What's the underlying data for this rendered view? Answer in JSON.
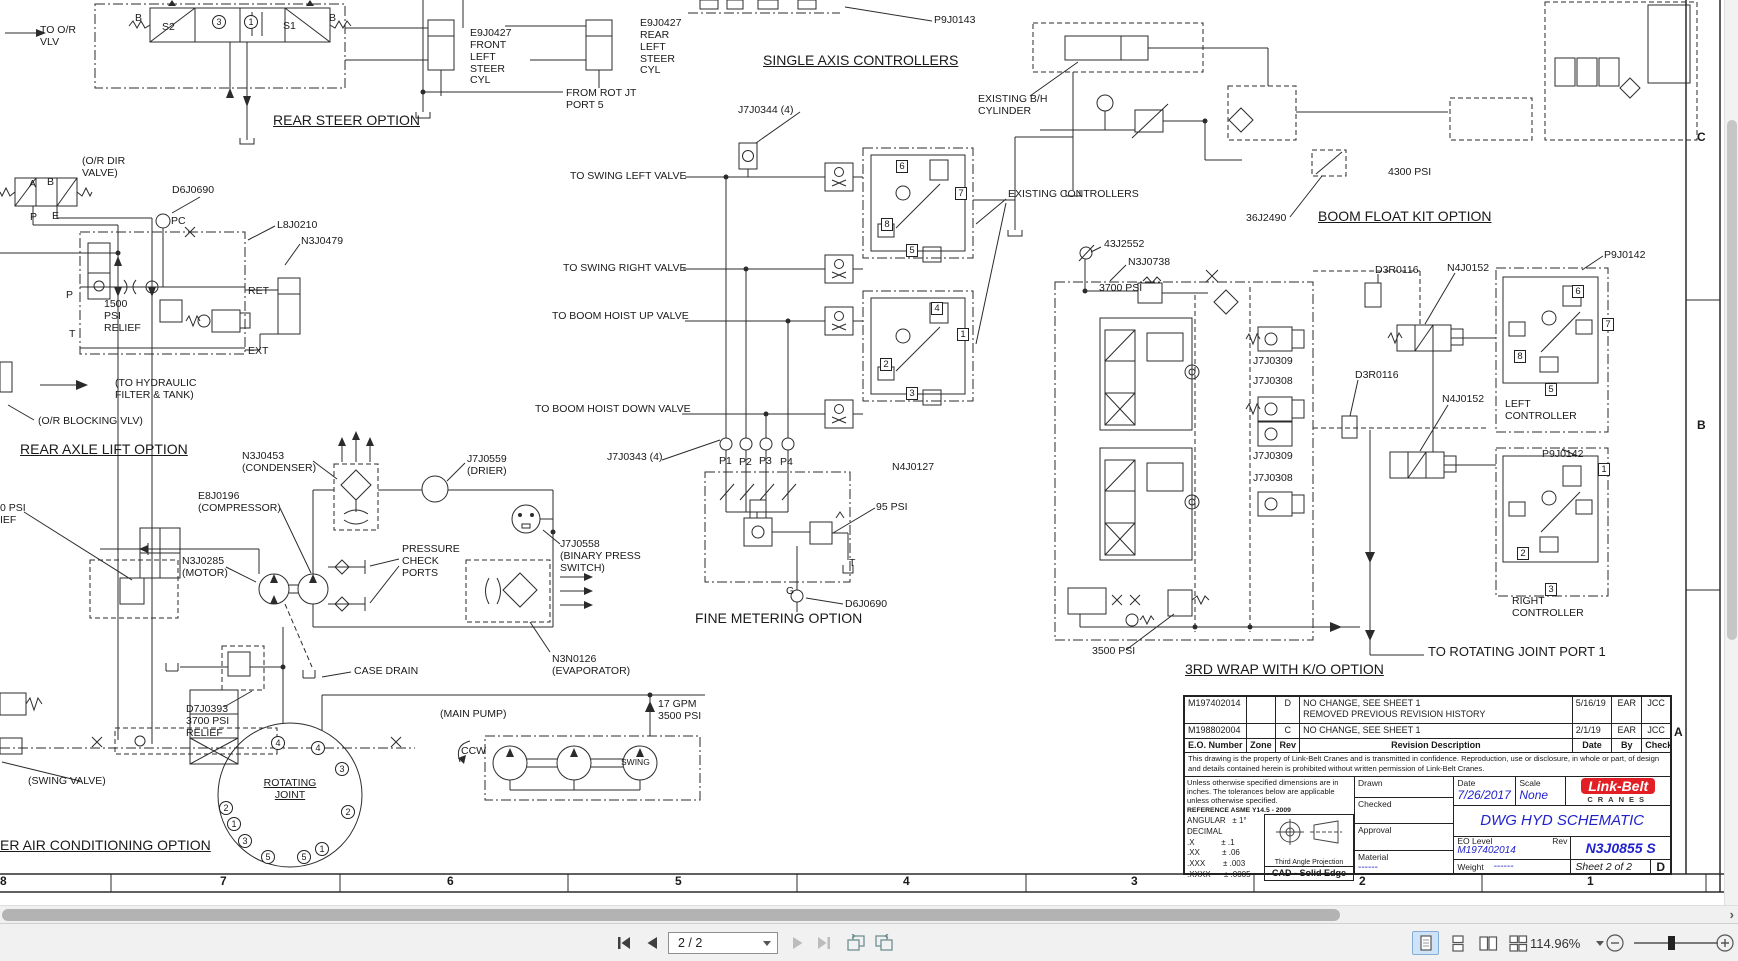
{
  "viewer": {
    "toolbar": {
      "page_indicator": "2 / 2",
      "zoom_value": "114.96%",
      "icons": {
        "first_page": "bar-left-triangle",
        "previous_page": "left-triangle",
        "next_page": "right-triangle",
        "last_page": "right-triangle-bar",
        "rotate_left": "page-rotate-left",
        "rotate_right": "page-rotate-right",
        "layout_modes": [
          "single-page",
          "one-column",
          "two-page",
          "two-column"
        ],
        "zoom_out": "minus-circle",
        "zoom_in": "plus-circle"
      }
    },
    "hscroll_arrow": "›"
  },
  "drawing": {
    "title_block": {
      "revision_table": {
        "headers": {
          "eo": "E.O. Number",
          "zone": "Zone",
          "rev": "Rev",
          "desc": "Revision Description",
          "date": "Date",
          "by": "By",
          "check": "Check"
        },
        "rows": [
          {
            "eo": "M197402014",
            "zone": "",
            "rev": "D",
            "desc": "NO CHANGE, SEE SHEET 1\nREMOVED PREVIOUS REVISION HISTORY",
            "date": "5/16/19",
            "by": "EAR",
            "check": "JCC"
          },
          {
            "eo": "M198802004",
            "zone": "",
            "rev": "C",
            "desc": "NO CHANGE, SEE SHEET 1",
            "date": "2/1/19",
            "by": "EAR",
            "check": "JCC"
          }
        ]
      },
      "property_note": "This drawing is the property of Link-Belt Cranes and is transmitted in confidence. Reproduction, use or disclosure, in whole or part, of design and details contained herein is prohibited without written permission of Link-Belt Cranes.",
      "tolerance_note": "Unless otherwise specified dimensions are in\ninches.  The tolerances below are applicable\nunless otherwise specified.",
      "reference": "REFERENCE ASME Y14.5 - 2009",
      "tolerances": [
        "ANGULAR   ± 1°",
        "DECIMAL",
        ".X            ± .1",
        ".XX          ± .06",
        ".XXX        ± .003",
        ".XXXX      ± .0005"
      ],
      "projection_label": "Third Angle Projection",
      "cad_label": "CAD - Solid Edge",
      "drawn_label": "Drawn",
      "checked_label": "Checked",
      "approval_label": "Approval",
      "material_label": "Material",
      "material_value": "------",
      "date_label": "Date",
      "date_value": "7/26/2017",
      "scale_label": "Scale",
      "scale_value": "None",
      "eo_level_label": "EO Level",
      "rev_label": "Rev",
      "eo_level_value": "M197402014",
      "weight_label": "Weight",
      "weight_value": "------",
      "drawing_title": "DWG HYD SCHEMATIC",
      "drawing_number": "N3J0855 S",
      "sheet_label": "Sheet 2 of 2",
      "size_letter": "D",
      "logo_brand": "Link-Belt",
      "logo_sub": "CRANES"
    },
    "labels": [
      {
        "t": "TO O/R\nVLV",
        "x": 40,
        "y": 25
      },
      {
        "t": "B",
        "x": 135,
        "y": 13
      },
      {
        "t": "S2",
        "x": 162,
        "y": 22
      },
      {
        "t": "3",
        "x": 212,
        "y": 15,
        "circ": 1
      },
      {
        "t": "1",
        "x": 244,
        "y": 15,
        "circ": 1
      },
      {
        "t": "S1",
        "x": 283,
        "y": 21
      },
      {
        "t": "B",
        "x": 329,
        "y": 13
      },
      {
        "t": "REAR STEER OPTION",
        "x": 273,
        "y": 113,
        "s": 14,
        "u": 1,
        "n": "title-rear-steer-option"
      },
      {
        "t": "E9J0427\nFRONT\nLEFT\nSTEER\nCYL",
        "x": 470,
        "y": 28
      },
      {
        "t": "E9J0427\nREAR\nLEFT\nSTEER\nCYL",
        "x": 640,
        "y": 18
      },
      {
        "t": "FROM ROT JT\nPORT 5",
        "x": 566,
        "y": 88
      },
      {
        "t": "SINGLE AXIS CONTROLLERS",
        "x": 763,
        "y": 53,
        "s": 14,
        "u": 1,
        "n": "title-single-axis-controllers"
      },
      {
        "t": "P9J0143",
        "x": 934,
        "y": 15
      },
      {
        "t": "J7J0344 (4)",
        "x": 738,
        "y": 105
      },
      {
        "t": "EXISTING B/H\nCYLINDER",
        "x": 978,
        "y": 94
      },
      {
        "t": "EXISTING CONTROLLERS",
        "x": 1008,
        "y": 189
      },
      {
        "t": "4300 PSI",
        "x": 1388,
        "y": 167
      },
      {
        "t": "36J2490",
        "x": 1246,
        "y": 213
      },
      {
        "t": "BOOM FLOAT KIT OPTION",
        "x": 1318,
        "y": 209,
        "s": 14,
        "u": 1,
        "n": "title-boom-float-kit-option"
      },
      {
        "t": "(O/R DIR\nVALVE)",
        "x": 82,
        "y": 156
      },
      {
        "t": "A",
        "x": 29,
        "y": 179
      },
      {
        "t": "B",
        "x": 47,
        "y": 177
      },
      {
        "t": "P",
        "x": 30,
        "y": 212
      },
      {
        "t": "E",
        "x": 52,
        "y": 211
      },
      {
        "t": "D6J0690",
        "x": 172,
        "y": 185
      },
      {
        "t": "PC",
        "x": 171,
        "y": 216
      },
      {
        "t": "L8J0210",
        "x": 277,
        "y": 220
      },
      {
        "t": "N3J0479",
        "x": 301,
        "y": 236
      },
      {
        "t": "1500\nPSI\nRELIEF",
        "x": 104,
        "y": 299
      },
      {
        "t": "P",
        "x": 66,
        "y": 290
      },
      {
        "t": "T",
        "x": 69,
        "y": 329
      },
      {
        "t": "RET",
        "x": 248,
        "y": 286
      },
      {
        "t": "EXT",
        "x": 248,
        "y": 346
      },
      {
        "t": "(TO HYDRAULIC\nFILTER & TANK)",
        "x": 115,
        "y": 378
      },
      {
        "t": "(O/R BLOCKING VLV)",
        "x": 38,
        "y": 416
      },
      {
        "t": "REAR AXLE LIFT OPTION",
        "x": 20,
        "y": 442,
        "s": 14,
        "u": 1,
        "n": "title-rear-axle-lift-option"
      },
      {
        "t": "0 PSI",
        "x": 0,
        "y": 503
      },
      {
        "t": "IEF",
        "x": 0,
        "y": 515
      },
      {
        "t": "TO SWING LEFT VALVE",
        "x": 570,
        "y": 171
      },
      {
        "t": "TO SWING RIGHT VALVE",
        "x": 563,
        "y": 263
      },
      {
        "t": "TO BOOM HOIST UP VALVE",
        "x": 552,
        "y": 311
      },
      {
        "t": "TO BOOM HOIST DOWN VALVE",
        "x": 535,
        "y": 404
      },
      {
        "t": "6",
        "x": 896,
        "y": 160,
        "box": 1
      },
      {
        "t": "7",
        "x": 955,
        "y": 187,
        "box": 1
      },
      {
        "t": "8",
        "x": 881,
        "y": 218,
        "box": 1
      },
      {
        "t": "5",
        "x": 906,
        "y": 244,
        "box": 1
      },
      {
        "t": "4",
        "x": 931,
        "y": 302,
        "box": 1
      },
      {
        "t": "1",
        "x": 957,
        "y": 328,
        "box": 1
      },
      {
        "t": "2",
        "x": 880,
        "y": 358,
        "box": 1
      },
      {
        "t": "3",
        "x": 906,
        "y": 387,
        "box": 1
      },
      {
        "t": "J7J0343 (4)",
        "x": 607,
        "y": 452
      },
      {
        "t": "P1",
        "x": 719,
        "y": 456
      },
      {
        "t": "P2",
        "x": 739,
        "y": 457
      },
      {
        "t": "P3",
        "x": 759,
        "y": 456
      },
      {
        "t": "P4",
        "x": 780,
        "y": 457
      },
      {
        "t": "N4J0127",
        "x": 892,
        "y": 462
      },
      {
        "t": "95 PSI",
        "x": 876,
        "y": 502
      },
      {
        "t": "T",
        "x": 849,
        "y": 558
      },
      {
        "t": "G",
        "x": 786,
        "y": 586
      },
      {
        "t": "D6J0690",
        "x": 845,
        "y": 599
      },
      {
        "t": "FINE METERING OPTION",
        "x": 695,
        "y": 611,
        "s": 14,
        "n": "title-fine-metering-option"
      },
      {
        "t": "N3J0453\n(CONDENSER)",
        "x": 242,
        "y": 451
      },
      {
        "t": "J7J0559\n(DRIER)",
        "x": 467,
        "y": 454
      },
      {
        "t": "E8J0196\n(COMPRESSOR)",
        "x": 198,
        "y": 491
      },
      {
        "t": "N3J0285\n(MOTOR)",
        "x": 182,
        "y": 556
      },
      {
        "t": "PRESSURE\nCHECK\nPORTS",
        "x": 402,
        "y": 544
      },
      {
        "t": "J7J0558\n(BINARY PRESS\nSWITCH)",
        "x": 560,
        "y": 539
      },
      {
        "t": "CASE DRAIN",
        "x": 354,
        "y": 666
      },
      {
        "t": "N3N0126\n(EVAPORATOR)",
        "x": 552,
        "y": 654
      },
      {
        "t": "D7J0393\n3700 PSI\nRELIEF",
        "x": 186,
        "y": 704
      },
      {
        "t": "ROTATING\nJOINT",
        "x": 258,
        "y": 778,
        "u": 1,
        "ctr": 1,
        "w": 64,
        "n": "label-rotating-joint"
      },
      {
        "t": "4",
        "x": 271,
        "y": 736,
        "circ": 1
      },
      {
        "t": "4",
        "x": 311,
        "y": 741,
        "circ": 1
      },
      {
        "t": "3",
        "x": 335,
        "y": 762,
        "circ": 1
      },
      {
        "t": "2",
        "x": 341,
        "y": 805,
        "circ": 1
      },
      {
        "t": "1",
        "x": 315,
        "y": 842,
        "circ": 1
      },
      {
        "t": "5",
        "x": 297,
        "y": 850,
        "circ": 1
      },
      {
        "t": "5",
        "x": 261,
        "y": 850,
        "circ": 1
      },
      {
        "t": "3",
        "x": 238,
        "y": 834,
        "circ": 1
      },
      {
        "t": "1",
        "x": 227,
        "y": 817,
        "circ": 1
      },
      {
        "t": "2",
        "x": 219,
        "y": 801,
        "circ": 1
      },
      {
        "t": "(SWING VALVE)",
        "x": 28,
        "y": 776
      },
      {
        "t": "ER AIR CONDITIONING OPTION",
        "x": 0,
        "y": 838,
        "s": 14,
        "u": 1,
        "n": "title-air-conditioning-option"
      },
      {
        "t": "(MAIN PUMP)",
        "x": 440,
        "y": 709
      },
      {
        "t": "CCW",
        "x": 461,
        "y": 746
      },
      {
        "t": "SWING",
        "x": 621,
        "y": 758,
        "s": 8.5
      },
      {
        "t": "17 GPM\n3500 PSI",
        "x": 658,
        "y": 699
      },
      {
        "t": "43J2552",
        "x": 1104,
        "y": 239
      },
      {
        "t": "N3J0738",
        "x": 1128,
        "y": 257
      },
      {
        "t": "3700 PSI",
        "x": 1099,
        "y": 283
      },
      {
        "t": "D3R0116",
        "x": 1375,
        "y": 265
      },
      {
        "t": "N4J0152",
        "x": 1447,
        "y": 263
      },
      {
        "t": "J7J0309",
        "x": 1253,
        "y": 356
      },
      {
        "t": "J7J0308",
        "x": 1253,
        "y": 376
      },
      {
        "t": "D3R0116",
        "x": 1355,
        "y": 370
      },
      {
        "t": "N4J0152",
        "x": 1442,
        "y": 394
      },
      {
        "t": "J7J0309",
        "x": 1253,
        "y": 451
      },
      {
        "t": "J7J0308",
        "x": 1253,
        "y": 473
      },
      {
        "t": "P9J0142",
        "x": 1604,
        "y": 250
      },
      {
        "t": "P9J0142",
        "x": 1542,
        "y": 449
      },
      {
        "t": "6",
        "x": 1572,
        "y": 285,
        "box": 1
      },
      {
        "t": "7",
        "x": 1602,
        "y": 318,
        "box": 1
      },
      {
        "t": "8",
        "x": 1514,
        "y": 350,
        "box": 1
      },
      {
        "t": "5",
        "x": 1545,
        "y": 383,
        "box": 1
      },
      {
        "t": "LEFT\nCONTROLLER",
        "x": 1505,
        "y": 399
      },
      {
        "t": "1",
        "x": 1598,
        "y": 463,
        "box": 1
      },
      {
        "t": "2",
        "x": 1517,
        "y": 547,
        "box": 1
      },
      {
        "t": "3",
        "x": 1545,
        "y": 583,
        "box": 1
      },
      {
        "t": "RIGHT\nCONTROLLER",
        "x": 1512,
        "y": 596
      },
      {
        "t": "3500 PSI",
        "x": 1092,
        "y": 646
      },
      {
        "t": "3RD WRAP WITH K/O OPTION",
        "x": 1185,
        "y": 662,
        "s": 14,
        "u": 1,
        "n": "title-3rd-wrap-option"
      },
      {
        "t": "TO ROTATING JOINT PORT 1",
        "x": 1428,
        "y": 645,
        "s": 13
      },
      {
        "t": "C",
        "x": 1697,
        "y": 131,
        "s": 12,
        "b": 1,
        "n": "zone-letter-c"
      },
      {
        "t": "B",
        "x": 1697,
        "y": 419,
        "s": 12,
        "b": 1,
        "n": "zone-letter-b"
      },
      {
        "t": "A",
        "x": 1674,
        "y": 726,
        "s": 12,
        "b": 1,
        "n": "zone-letter-a"
      },
      {
        "t": "8",
        "x": 0,
        "y": 875,
        "s": 12,
        "b": 1,
        "n": "zone-number"
      },
      {
        "t": "7",
        "x": 220,
        "y": 875,
        "s": 12,
        "b": 1,
        "n": "zone-number"
      },
      {
        "t": "6",
        "x": 447,
        "y": 875,
        "s": 12,
        "b": 1,
        "n": "zone-number"
      },
      {
        "t": "5",
        "x": 675,
        "y": 875,
        "s": 12,
        "b": 1,
        "n": "zone-number"
      },
      {
        "t": "4",
        "x": 903,
        "y": 875,
        "s": 12,
        "b": 1,
        "n": "zone-number"
      },
      {
        "t": "3",
        "x": 1131,
        "y": 875,
        "s": 12,
        "b": 1,
        "n": "zone-number"
      },
      {
        "t": "2",
        "x": 1359,
        "y": 875,
        "s": 12,
        "b": 1,
        "n": "zone-number"
      },
      {
        "t": "1",
        "x": 1587,
        "y": 875,
        "s": 12,
        "b": 1,
        "n": "zone-number"
      }
    ]
  }
}
